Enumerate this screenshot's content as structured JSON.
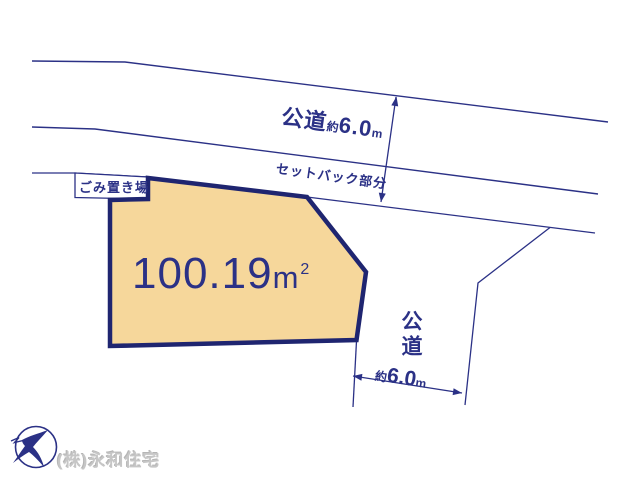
{
  "colors": {
    "navy_line": "#2b3186",
    "plot_border": "#1f2570",
    "plot_fill": "#f6d79b",
    "company_gray": "#c6c6c6",
    "background": "#ffffff"
  },
  "icons": {
    "logo": "crane-bird-logo"
  },
  "top_road": {
    "name": "公道",
    "approx": "約",
    "width_value": "6.0",
    "unit": "m"
  },
  "setback": {
    "label": "セットバック部分"
  },
  "garbage_area": {
    "label": "ごみ置き場"
  },
  "plot": {
    "area_value": "100.19",
    "area_unit": "m",
    "area_exponent": "2"
  },
  "side_road": {
    "name": "公道",
    "approx": "約",
    "width_value": "6.0",
    "unit": "m"
  },
  "footer": {
    "company": "(株)永和住宅"
  }
}
